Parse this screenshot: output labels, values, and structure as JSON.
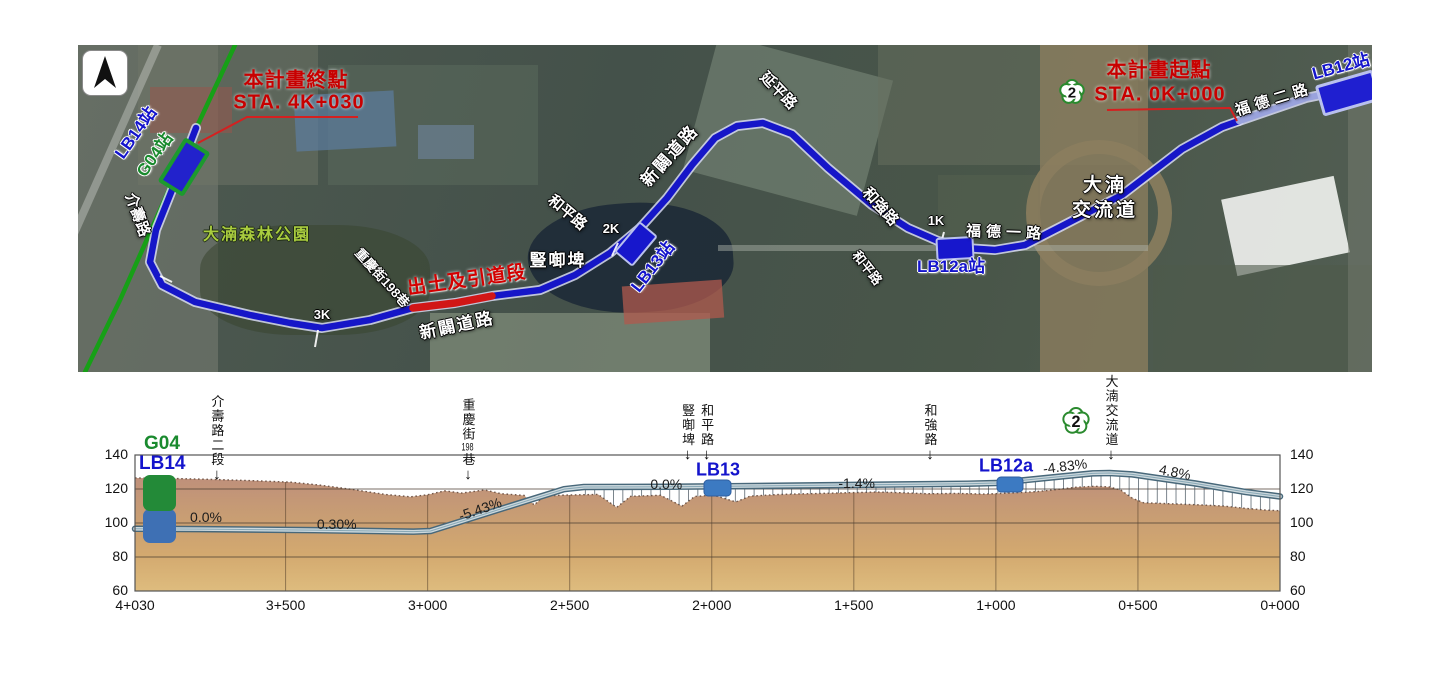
{
  "map": {
    "north_arrow_icon": "compass-north-arrow",
    "highway_shield": {
      "number": "2"
    },
    "labels": [
      {
        "id": "lb14-station-map-label",
        "text": "LB14站",
        "x": 58,
        "y": 88,
        "rot": -55,
        "cls": "blue-st"
      },
      {
        "id": "g04-station-map-label",
        "text": "G04站",
        "x": 77,
        "y": 110,
        "rot": -55,
        "cls": "green-st"
      },
      {
        "id": "jieshou-road-label",
        "text": "介壽路",
        "x": 59,
        "y": 170,
        "rot": 70,
        "cls": "road"
      },
      {
        "id": "danan-forest-park-label",
        "text": "大湳森林公園",
        "x": 179,
        "y": 191,
        "rot": 0,
        "cls": "park"
      },
      {
        "id": "chongqing-st-198-label",
        "text": "重慶街198巷",
        "x": 304,
        "y": 233,
        "rot": 48,
        "cls": "road sm"
      },
      {
        "id": "portal-ramp-section-label",
        "text": "出土及引道段",
        "x": 389,
        "y": 236,
        "rot": -8,
        "cls": "red-seg"
      },
      {
        "id": "new-road-label-lower",
        "text": "新闢道路",
        "x": 379,
        "y": 281,
        "rot": -12,
        "cls": "road lg"
      },
      {
        "id": "pond-label",
        "text": "豎啣埤",
        "x": 480,
        "y": 216,
        "rot": 0,
        "cls": "road lg"
      },
      {
        "id": "heping-road-label-upper",
        "text": "和平路",
        "x": 489,
        "y": 168,
        "rot": 40,
        "cls": "road"
      },
      {
        "id": "chainage-marker-2k",
        "text": "2K",
        "x": 533,
        "y": 184,
        "rot": 0,
        "cls": "road sm"
      },
      {
        "id": "lb13-station-map-label",
        "text": "LB13站",
        "x": 575,
        "y": 222,
        "rot": -52,
        "cls": "blue-st"
      },
      {
        "id": "new-road-label-upper",
        "text": "新闢道路",
        "x": 592,
        "y": 111,
        "rot": -48,
        "cls": "road lg"
      },
      {
        "id": "yanping-road-label",
        "text": "延平路",
        "x": 700,
        "y": 46,
        "rot": 46,
        "cls": "road"
      },
      {
        "id": "heqiang-road-label",
        "text": "和強路",
        "x": 802,
        "y": 162,
        "rot": 48,
        "cls": "road"
      },
      {
        "id": "chainage-marker-1k",
        "text": "1K",
        "x": 858,
        "y": 176,
        "rot": 0,
        "cls": "road sm"
      },
      {
        "id": "heping-road-label-lower",
        "text": "和平路",
        "x": 789,
        "y": 223,
        "rot": 52,
        "cls": "road sm"
      },
      {
        "id": "fude-1st-road-label",
        "text": "福德一路",
        "x": 928,
        "y": 188,
        "rot": 2,
        "cls": "road sp"
      },
      {
        "id": "lb12a-station-map-label",
        "text": "LB12a站",
        "x": 873,
        "y": 222,
        "rot": 0,
        "cls": "blue-st"
      },
      {
        "id": "danan-interchange-label-line1",
        "text": "大湳",
        "x": 1027,
        "y": 141,
        "rot": 0,
        "cls": "road xl"
      },
      {
        "id": "danan-interchange-label-line2",
        "text": "交流道",
        "x": 1027,
        "y": 166,
        "rot": 0,
        "cls": "road xl"
      },
      {
        "id": "fude-2nd-road-label",
        "text": "福德二路",
        "x": 1196,
        "y": 55,
        "rot": -17,
        "cls": "road sp"
      },
      {
        "id": "lb12-station-map-label",
        "text": "LB12站",
        "x": 1263,
        "y": 22,
        "rot": -15,
        "cls": "blue-st"
      },
      {
        "id": "project-end-title",
        "text": "本計畫終點",
        "x": 218,
        "y": 36,
        "rot": 0,
        "cls": "red-ann"
      },
      {
        "id": "project-end-sta",
        "text": "STA. 4K+030",
        "x": 221,
        "y": 58,
        "rot": 0,
        "cls": "red-ann"
      },
      {
        "id": "project-start-title",
        "text": "本計畫起點",
        "x": 1081,
        "y": 26,
        "rot": 0,
        "cls": "red-ann"
      },
      {
        "id": "project-start-sta",
        "text": "STA. 0K+000",
        "x": 1082,
        "y": 50,
        "rot": 0,
        "cls": "red-ann"
      },
      {
        "id": "chainage-marker-3k",
        "text": "3K",
        "x": 244,
        "y": 270,
        "rot": 0,
        "cls": "road sm"
      }
    ],
    "colors": {
      "route_blue": "#1616c8",
      "route_casing": "#d4d7f2",
      "elevated_lavender": "#9aa3dd",
      "portal_red": "#d11616",
      "green_line": "#17a017",
      "annotation_red": "#c80000"
    }
  },
  "profile": {
    "station_labels": [
      {
        "id": "G04",
        "text": "G04",
        "color": "#1a8a2e"
      },
      {
        "id": "LB14",
        "text": "LB14",
        "color": "#1414cc"
      },
      {
        "id": "LB13",
        "text": "LB13",
        "color": "#1414cc"
      },
      {
        "id": "LB12a",
        "text": "LB12a",
        "color": "#1414cc"
      }
    ],
    "highway_shield": {
      "number": "2"
    }
  },
  "chart_data": {
    "type": "line",
    "axis_range": {
      "x_chainage": [
        0,
        4030
      ],
      "y_elevation": [
        60,
        140
      ]
    },
    "y_ticks": [
      140,
      120,
      100,
      80,
      60
    ],
    "x_ticks": [
      {
        "label": "4+030",
        "chainage": 4030
      },
      {
        "label": "3+500",
        "chainage": 3500
      },
      {
        "label": "3+000",
        "chainage": 3000
      },
      {
        "label": "2+500",
        "chainage": 2500
      },
      {
        "label": "2+000",
        "chainage": 2000
      },
      {
        "label": "1+500",
        "chainage": 1500
      },
      {
        "label": "1+000",
        "chainage": 1000
      },
      {
        "label": "0+500",
        "chainage": 500
      },
      {
        "label": "0+000",
        "chainage": 0
      }
    ],
    "series": [
      {
        "name": "alignment",
        "points": [
          [
            4030,
            96.6
          ],
          [
            3800,
            96.4
          ],
          [
            3400,
            95.8
          ],
          [
            3050,
            94.9
          ],
          [
            2990,
            95.3
          ],
          [
            2520,
            119.9
          ],
          [
            2450,
            121.2
          ],
          [
            2150,
            121.3
          ],
          [
            1900,
            121.7
          ],
          [
            1100,
            123.1
          ],
          [
            1000,
            123.5
          ],
          [
            780,
            127.2
          ],
          [
            660,
            129.2
          ],
          [
            600,
            129.4
          ],
          [
            520,
            128.6
          ],
          [
            300,
            123.3
          ],
          [
            120,
            118.2
          ],
          [
            0,
            115.6
          ]
        ]
      },
      {
        "name": "ground",
        "points": [
          [
            4030,
            126.5
          ],
          [
            3900,
            126.2
          ],
          [
            3750,
            125.6
          ],
          [
            3600,
            124.8
          ],
          [
            3480,
            124
          ],
          [
            3380,
            122.3
          ],
          [
            3260,
            119.6
          ],
          [
            3150,
            116.8
          ],
          [
            3060,
            115.4
          ],
          [
            3000,
            116.6
          ],
          [
            2940,
            118.9
          ],
          [
            2880,
            117.6
          ],
          [
            2800,
            119.4
          ],
          [
            2740,
            117.2
          ],
          [
            2660,
            116.2
          ],
          [
            2625,
            110.6
          ],
          [
            2590,
            115.8
          ],
          [
            2520,
            116.4
          ],
          [
            2400,
            116.8
          ],
          [
            2335,
            109.2
          ],
          [
            2285,
            115.7
          ],
          [
            2180,
            116.3
          ],
          [
            2105,
            109.9
          ],
          [
            2060,
            115.6
          ],
          [
            1995,
            116.4
          ],
          [
            1915,
            112.4
          ],
          [
            1865,
            115.8
          ],
          [
            1760,
            116.8
          ],
          [
            1640,
            117.3
          ],
          [
            1520,
            117.8
          ],
          [
            1420,
            118.2
          ],
          [
            1330,
            117.8
          ],
          [
            1240,
            117.2
          ],
          [
            1140,
            117.4
          ],
          [
            1040,
            117
          ],
          [
            950,
            117.6
          ],
          [
            860,
            118.4
          ],
          [
            790,
            119.6
          ],
          [
            720,
            121
          ],
          [
            650,
            121.6
          ],
          [
            600,
            121.2
          ],
          [
            560,
            119.3
          ],
          [
            520,
            114.6
          ],
          [
            480,
            111.9
          ],
          [
            430,
            111.6
          ],
          [
            370,
            111.2
          ],
          [
            290,
            110.7
          ],
          [
            200,
            110
          ],
          [
            120,
            108.6
          ],
          [
            50,
            107.6
          ],
          [
            0,
            107.2
          ]
        ]
      }
    ],
    "elevated_span_chainage": [
      2450,
      0
    ],
    "grade_labels": [
      {
        "text": "0.0%",
        "chainage": 3780,
        "elev": 103.3,
        "rot": 0
      },
      {
        "text": "0.30%",
        "chainage": 3320,
        "elev": 99.5,
        "rot": 0
      },
      {
        "text": "-5.43%",
        "chainage": 2816,
        "elev": 108.0,
        "rot": -19
      },
      {
        "text": "0.0%",
        "chainage": 2160,
        "elev": 123.0,
        "rot": 0
      },
      {
        "text": "-1.4%",
        "chainage": 1490,
        "elev": 123.6,
        "rot": 0
      },
      {
        "text": "-4.83%",
        "chainage": 758,
        "elev": 133.4,
        "rot": -7
      },
      {
        "text": "4.8%",
        "chainage": 368,
        "elev": 130.0,
        "rot": 11
      }
    ],
    "crossings": [
      {
        "label": "介壽路二段",
        "chainage": 3742,
        "arrow_tip_y": 483
      },
      {
        "label": "重慶街198巷",
        "chainage": 2858,
        "arrow_tip_y": 483
      },
      {
        "label": "豎啣埤",
        "chainage": 2085,
        "arrow_tip_y": 463
      },
      {
        "label": "和平路",
        "chainage": 2018,
        "arrow_tip_y": 463
      },
      {
        "label": "和強路",
        "chainage": 1232,
        "arrow_tip_y": 463
      },
      {
        "label": "大湳交流道",
        "chainage": 595,
        "arrow_tip_y": 463,
        "shield": "2"
      }
    ],
    "stations_on_profile": [
      {
        "label": "G04/LB14",
        "chainage": 4000
      },
      {
        "label": "LB13",
        "chainage": 2030
      },
      {
        "label": "LB12a",
        "chainage": 1010
      }
    ]
  }
}
